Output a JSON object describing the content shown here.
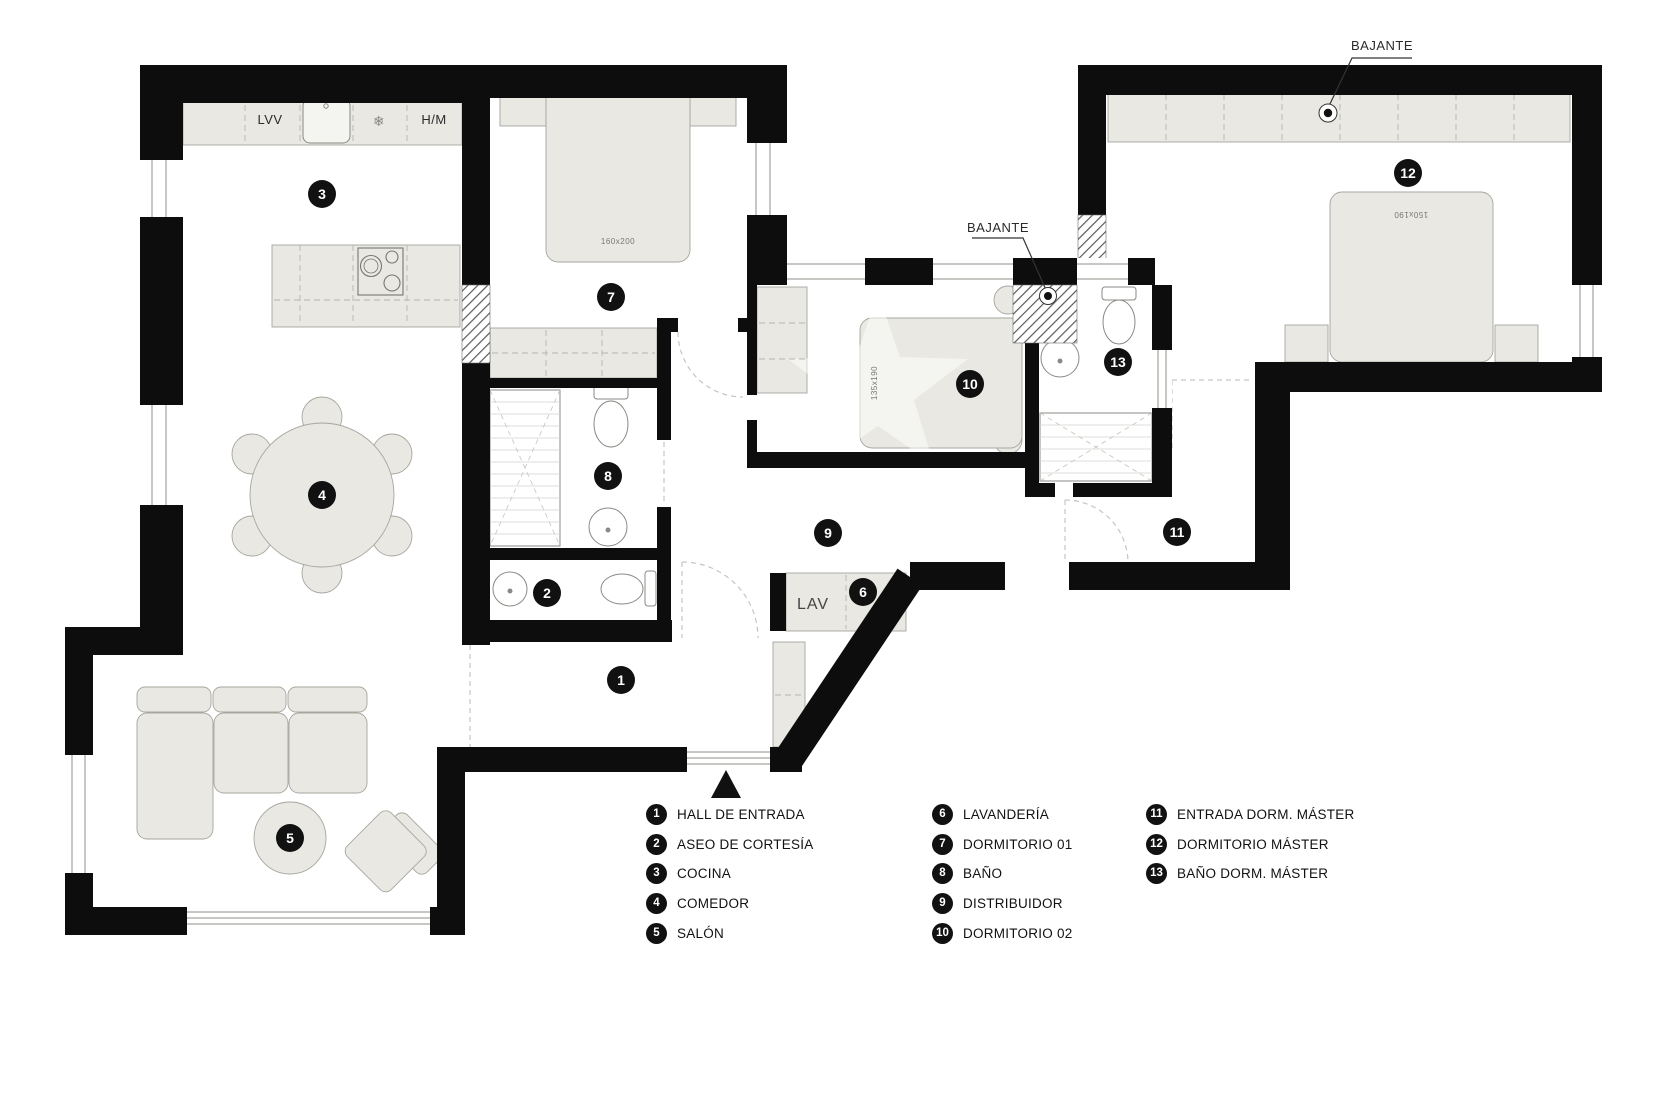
{
  "title": "Plano de vivienda",
  "rooms": [
    {
      "num": "1",
      "label": "HALL DE ENTRADA"
    },
    {
      "num": "2",
      "label": "ASEO DE CORTESÍA"
    },
    {
      "num": "3",
      "label": "COCINA"
    },
    {
      "num": "4",
      "label": "COMEDOR"
    },
    {
      "num": "5",
      "label": "SALÓN"
    },
    {
      "num": "6",
      "label": "LAVANDERÍA"
    },
    {
      "num": "7",
      "label": "DORMITORIO 01"
    },
    {
      "num": "8",
      "label": "BAÑO"
    },
    {
      "num": "9",
      "label": "DISTRIBUIDOR"
    },
    {
      "num": "10",
      "label": "DORMITORIO 02"
    },
    {
      "num": "11",
      "label": "ENTRADA DORM. MÁSTER"
    },
    {
      "num": "12",
      "label": "DORMITORIO MÁSTER"
    },
    {
      "num": "13",
      "label": "BAÑO DORM. MÁSTER"
    }
  ],
  "annotations": {
    "bajante_top": "BAJANTE",
    "bajante_mid": "BAJANTE",
    "lav": "LAV",
    "lvv": "LVV",
    "hm": "H/M",
    "snowflake": "❄",
    "bed7_size": "160x200",
    "bed10_size": "135x190",
    "bed12_size": "150x190"
  },
  "colors": {
    "wall": "#0d0d0d",
    "furniture": "#e9e8e2",
    "fixture_stroke": "#8a8a84"
  }
}
